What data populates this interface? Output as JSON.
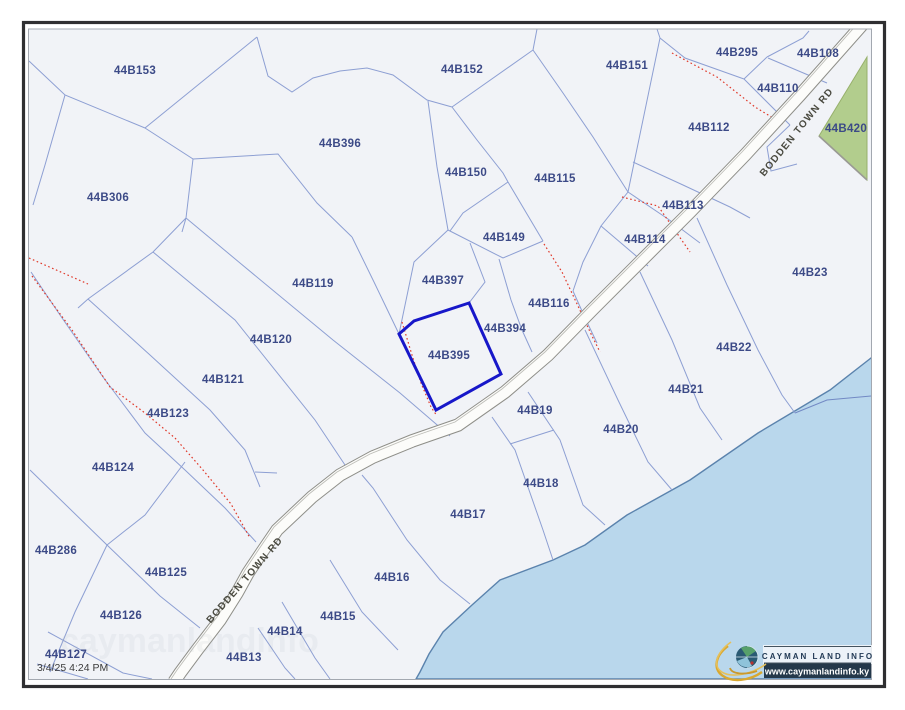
{
  "map": {
    "highlighted_parcel": "44B395",
    "parcels": [
      {
        "id": "44B153",
        "x": 135,
        "y": 70
      },
      {
        "id": "44B306",
        "x": 108,
        "y": 197
      },
      {
        "id": "44B396",
        "x": 340,
        "y": 143
      },
      {
        "id": "44B152",
        "x": 462,
        "y": 69
      },
      {
        "id": "44B150",
        "x": 466,
        "y": 172
      },
      {
        "id": "44B115",
        "x": 555,
        "y": 178
      },
      {
        "id": "44B151",
        "x": 627,
        "y": 65
      },
      {
        "id": "44B295",
        "x": 737,
        "y": 52
      },
      {
        "id": "44B108",
        "x": 818,
        "y": 53
      },
      {
        "id": "44B110",
        "x": 778,
        "y": 88
      },
      {
        "id": "44B112",
        "x": 709,
        "y": 127
      },
      {
        "id": "44B420",
        "x": 846,
        "y": 128
      },
      {
        "id": "44B113",
        "x": 683,
        "y": 205
      },
      {
        "id": "44B114",
        "x": 645,
        "y": 239
      },
      {
        "id": "44B149",
        "x": 504,
        "y": 237
      },
      {
        "id": "44B23",
        "x": 810,
        "y": 272
      },
      {
        "id": "44B119",
        "x": 313,
        "y": 283
      },
      {
        "id": "44B397",
        "x": 443,
        "y": 280
      },
      {
        "id": "44B116",
        "x": 549,
        "y": 303
      },
      {
        "id": "44B394",
        "x": 505,
        "y": 328
      },
      {
        "id": "44B395",
        "x": 449,
        "y": 355
      },
      {
        "id": "44B120",
        "x": 271,
        "y": 339
      },
      {
        "id": "44B22",
        "x": 734,
        "y": 347
      },
      {
        "id": "44B121",
        "x": 223,
        "y": 379
      },
      {
        "id": "44B21",
        "x": 686,
        "y": 389
      },
      {
        "id": "44B19",
        "x": 535,
        "y": 410
      },
      {
        "id": "44B123",
        "x": 168,
        "y": 413
      },
      {
        "id": "44B20",
        "x": 621,
        "y": 429
      },
      {
        "id": "44B124",
        "x": 113,
        "y": 467
      },
      {
        "id": "44B18",
        "x": 541,
        "y": 483
      },
      {
        "id": "44B17",
        "x": 468,
        "y": 514
      },
      {
        "id": "44B286",
        "x": 56,
        "y": 550
      },
      {
        "id": "44B125",
        "x": 166,
        "y": 572
      },
      {
        "id": "44B16",
        "x": 392,
        "y": 577
      },
      {
        "id": "44B126",
        "x": 121,
        "y": 615
      },
      {
        "id": "44B15",
        "x": 338,
        "y": 616
      },
      {
        "id": "44B14",
        "x": 285,
        "y": 631
      },
      {
        "id": "44B127",
        "x": 66,
        "y": 654
      },
      {
        "id": "44B13",
        "x": 244,
        "y": 657
      }
    ],
    "road": {
      "name": "BODDEN TOWN RD"
    },
    "timestamp": "3/4/25 4:24 PM",
    "logo": {
      "title": "CAYMAN LAND INFO",
      "url": "www.caymanlandinfo.ky"
    },
    "colors": {
      "map_background": "#f1f3f7",
      "parcel_line": "#8d9fd3",
      "parcel_label": "#3c4a87",
      "highlight_outline": "#1717c9",
      "pending_boundary_red": "#e0392a",
      "water_fill": "#b9d7ec",
      "water_edge": "#5b83ad",
      "green_parcel_fill": "#b2cd8d",
      "road_fill": "#fcfcfa",
      "road_casing": "#8e8e88"
    }
  }
}
